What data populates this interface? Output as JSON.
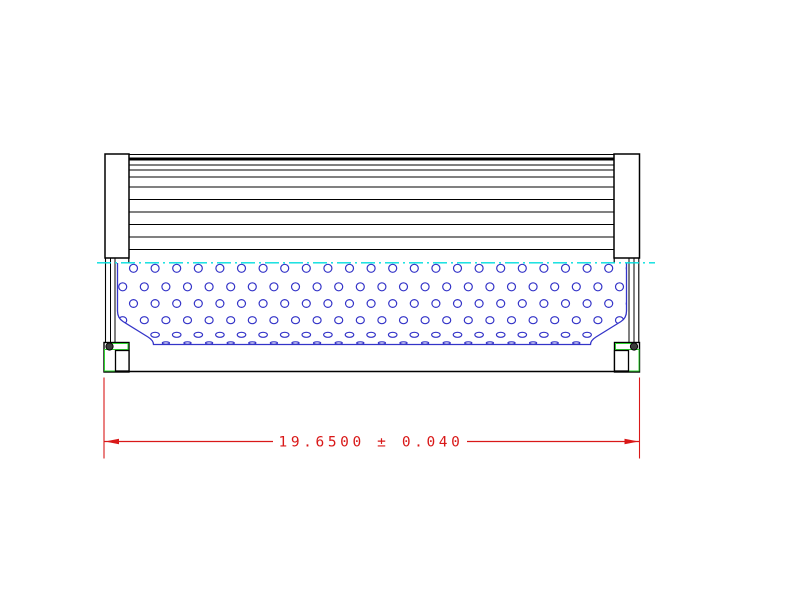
{
  "drawing": {
    "kind": "technical-drawing",
    "subject": "hydraulic filter element side cross-section",
    "dimension": {
      "label": "19.6500 ± 0.040",
      "value": "19.6500",
      "tolerance": "0.040"
    },
    "colors": {
      "line": "#000000",
      "core": "#3434c8",
      "center": "#00dede",
      "seal": "#2fd32f",
      "dim": "#d91818"
    },
    "pleat_lines": {
      "x1": 129,
      "x2": 614,
      "thin_ys": [
        154.5,
        165,
        170,
        177,
        187,
        199.5,
        212,
        224.5,
        237,
        249.5
      ],
      "thick_ys": [
        159
      ]
    },
    "core_holes": {
      "step": 21.6,
      "x_max": 632,
      "rows": [
        {
          "y": 268.3,
          "rx": 4.0,
          "ry": 4.0,
          "x0": 133.5
        },
        {
          "y": 286.8,
          "rx": 4.0,
          "ry": 4.0,
          "x0": 122.7
        },
        {
          "y": 303.5,
          "rx": 4.0,
          "ry": 3.9,
          "x0": 133.5
        },
        {
          "y": 320.2,
          "rx": 4.0,
          "ry": 3.5,
          "x0": 122.7
        },
        {
          "y": 334.8,
          "rx": 4.3,
          "ry": 2.5,
          "x0": 133.5
        },
        {
          "y": 343.0,
          "rx": 3.6,
          "ry": 1.2,
          "x0": 122.7
        }
      ]
    }
  }
}
